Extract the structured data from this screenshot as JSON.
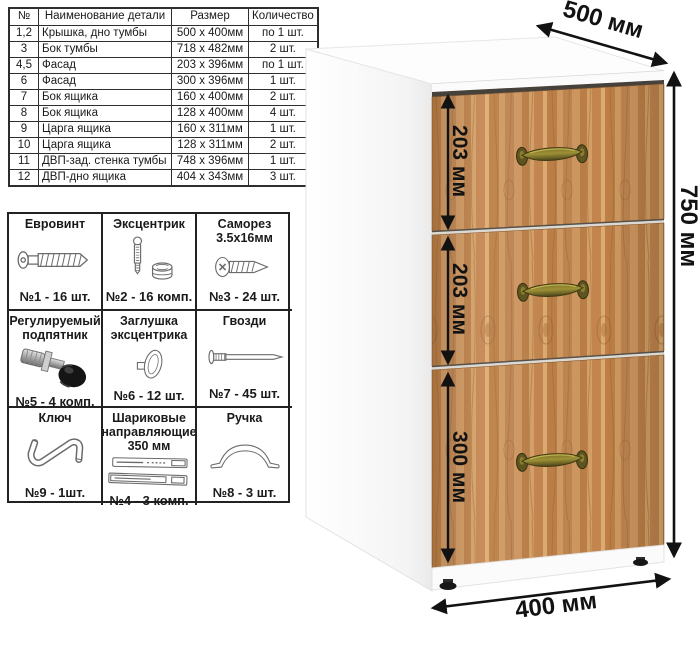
{
  "parts_table": {
    "headers": [
      "№",
      "Наименование детали",
      "Размер",
      "Количество"
    ],
    "rows": [
      [
        "1,2",
        "Крышка, дно тумбы",
        "500 x 400мм",
        "по 1 шт."
      ],
      [
        "3",
        "Бок тумбы",
        "718 x 482мм",
        "2 шт."
      ],
      [
        "4,5",
        "Фасад",
        "203 x 396мм",
        "по 1 шт."
      ],
      [
        "6",
        "Фасад",
        "300 x 396мм",
        "1 шт."
      ],
      [
        "7",
        "Бок ящика",
        "160 x 400мм",
        "2 шт."
      ],
      [
        "8",
        "Бок ящика",
        "128 x 400мм",
        "4 шт."
      ],
      [
        "9",
        "Царга ящика",
        "160 x 311мм",
        "1 шт."
      ],
      [
        "10",
        "Царга ящика",
        "128 x 311мм",
        "2 шт."
      ],
      [
        "11",
        "ДВП-зад. стенка тумбы",
        "748 x 396мм",
        "1 шт."
      ],
      [
        "12",
        "ДВП-дно ящика",
        "404 x 343мм",
        "3 шт."
      ]
    ]
  },
  "hardware_table": {
    "cells": [
      {
        "title": "Евровинт",
        "count": "№1 - 16 шт.",
        "icon": "euro-screw-icon"
      },
      {
        "title": "Эксцентрик",
        "count": "№2 - 16 комп.",
        "icon": "cam-lock-icon"
      },
      {
        "title": "Саморез 3.5x16мм",
        "count": "№3 - 24 шт.",
        "icon": "self-tapping-screw-icon"
      },
      {
        "title": "Регулируемый подпятник",
        "count": "№5 - 4 комп.",
        "icon": "adjustable-foot-icon"
      },
      {
        "title": "Заглушка эксцентрика",
        "count": "№6 - 12 шт.",
        "icon": "cam-cap-icon"
      },
      {
        "title": "Гвозди",
        "count": "№7 - 45 шт.",
        "icon": "nail-icon"
      },
      {
        "title": "Ключ",
        "count": "№9 - 1шт.",
        "icon": "hex-key-icon"
      },
      {
        "title": "Шариковые направляющие 350 мм",
        "count": "№4 - 3 комп.",
        "icon": "ball-bearing-slides-icon"
      },
      {
        "title": "Ручка",
        "count": "№8 - 3 шт.",
        "icon": "handle-icon"
      }
    ]
  },
  "cabinet": {
    "width_label": "500 мм",
    "height_label": "750 мм",
    "depth_label": "400 мм",
    "drawer_height_labels": [
      "203 мм",
      "203 мм",
      "300 мм"
    ],
    "drawer_count": 3
  },
  "colors": {
    "wood_base": "#c98f58",
    "wood_dark": "#a86e38",
    "handle_brass": "#9d9136",
    "dimension_ink": "#121212",
    "table_border": "#2e2e2e"
  }
}
